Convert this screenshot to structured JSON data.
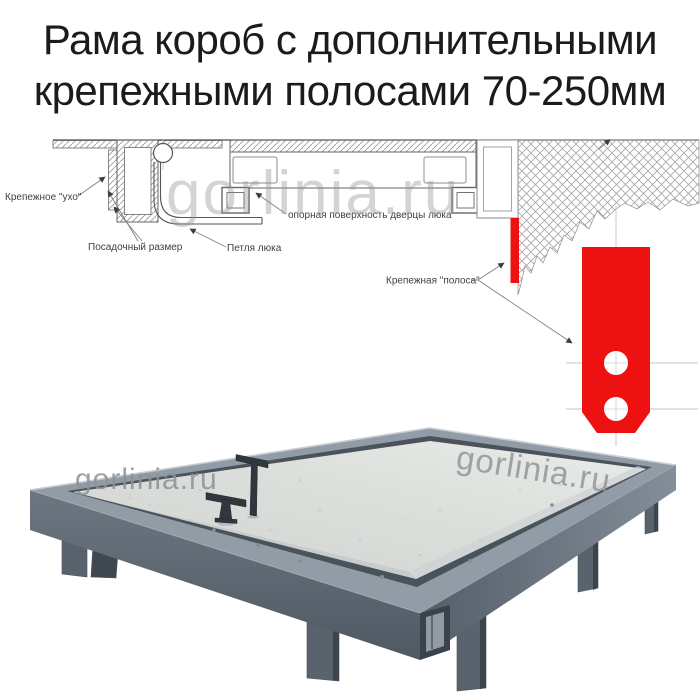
{
  "title": {
    "line1": "Рама короб с дополнительными",
    "line2": "крепежными полосами 70-250мм"
  },
  "watermark": {
    "text": "gorlinia.ru"
  },
  "diagram": {
    "labels": {
      "ear": "Крепежное \"ухо\"",
      "seat": "Посадочный размер",
      "hinge": "Петля люка",
      "support": "опорная поверхность дверцы люка",
      "strip": "Крепежная \"полоса\""
    }
  },
  "colors": {
    "title_text": "#1b1b1b",
    "red": "#ee1111",
    "drawing_line": "#4d4d4d",
    "label_text": "#3f3f3f",
    "watermark_gray": "#8e9293",
    "steel_rim": "#929ca7",
    "steel_side_dark": "#525c66",
    "steel_side_light": "#6e7884",
    "panel_gray": "#dadcd9",
    "handle_dark": "#31373d",
    "leg_gray": "#59636e"
  }
}
